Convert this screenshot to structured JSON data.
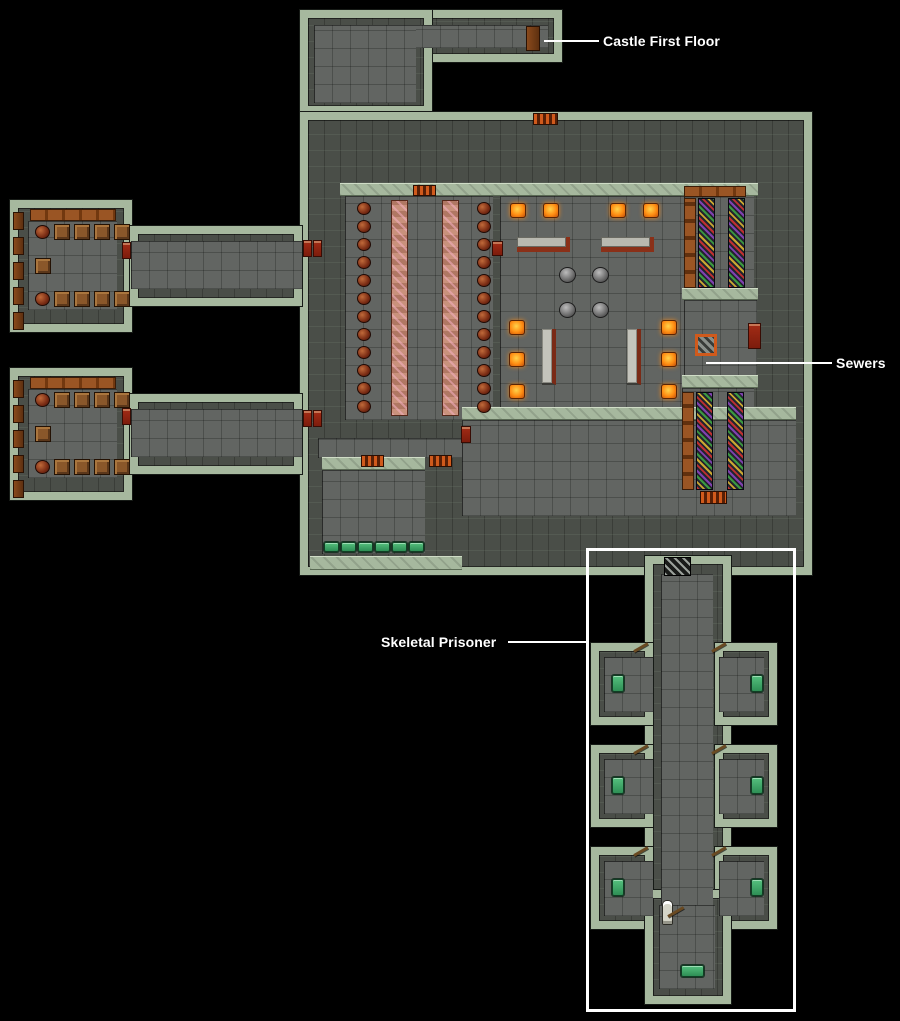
{
  "annotations": [
    {
      "id": "castle-first-floor",
      "text": "Castle First Floor"
    },
    {
      "id": "sewers",
      "text": "Sewers"
    },
    {
      "id": "skeletal-prisoner",
      "text": "Skeletal Prisoner"
    }
  ],
  "colors": {
    "background": "#000000",
    "wall_top": "#a6b89e",
    "wall_face": "#4a4e48",
    "floor": "#626562",
    "annotation": "#ffffff",
    "brazier": "#ff8c12",
    "barrel": "#7a2c14",
    "crate": "#8a572a",
    "bed_green": "#2e8f55",
    "banner_red": "#a32c16",
    "shelf_brown": "#9a5524",
    "grate_orange": "#d05a1c",
    "door_brown": "#8a4a1c"
  },
  "map": {
    "regions": [
      {
        "kind": "block",
        "name": "top-corridor",
        "x": 300,
        "y": 10,
        "w": 262,
        "h": 52
      },
      {
        "kind": "block",
        "name": "top-connector",
        "x": 300,
        "y": 10,
        "w": 132,
        "h": 104
      },
      {
        "kind": "block",
        "name": "main-dungeon",
        "x": 300,
        "y": 112,
        "w": 512,
        "h": 463
      },
      {
        "kind": "block",
        "name": "west-room-upper",
        "x": 10,
        "y": 200,
        "w": 122,
        "h": 132
      },
      {
        "kind": "block",
        "name": "west-corridor-upper",
        "x": 130,
        "y": 226,
        "w": 172,
        "h": 80
      },
      {
        "kind": "block",
        "name": "west-room-lower",
        "x": 10,
        "y": 368,
        "w": 122,
        "h": 132
      },
      {
        "kind": "block",
        "name": "west-corridor-lower",
        "x": 130,
        "y": 394,
        "w": 172,
        "h": 80
      },
      {
        "kind": "block",
        "name": "prison-corridor",
        "x": 645,
        "y": 556,
        "w": 86,
        "h": 380
      },
      {
        "kind": "block",
        "name": "prison-cell",
        "x": 591,
        "y": 643,
        "w": 62,
        "h": 82
      },
      {
        "kind": "block",
        "name": "prison-cell",
        "x": 715,
        "y": 643,
        "w": 62,
        "h": 82
      },
      {
        "kind": "block",
        "name": "prison-cell",
        "x": 591,
        "y": 745,
        "w": 62,
        "h": 82
      },
      {
        "kind": "block",
        "name": "prison-cell",
        "x": 715,
        "y": 745,
        "w": 62,
        "h": 82
      },
      {
        "kind": "block",
        "name": "prison-cell",
        "x": 591,
        "y": 847,
        "w": 62,
        "h": 82
      },
      {
        "kind": "block",
        "name": "prison-cell",
        "x": 715,
        "y": 847,
        "w": 62,
        "h": 82
      },
      {
        "kind": "block",
        "name": "prison-chamber",
        "x": 645,
        "y": 890,
        "w": 86,
        "h": 114
      },
      {
        "kind": "floor",
        "name": "top-corridor-floor",
        "x": 314,
        "y": 25,
        "w": 234,
        "h": 23
      },
      {
        "kind": "floor",
        "name": "top-connector-floor",
        "x": 314,
        "y": 25,
        "w": 102,
        "h": 78
      },
      {
        "kind": "floor",
        "name": "mess-hall",
        "x": 345,
        "y": 196,
        "w": 148,
        "h": 224
      },
      {
        "kind": "floor",
        "name": "great-hall",
        "x": 500,
        "y": 196,
        "w": 185,
        "h": 224
      },
      {
        "kind": "floor",
        "name": "armory-upper",
        "x": 684,
        "y": 190,
        "w": 70,
        "h": 98
      },
      {
        "kind": "floor",
        "name": "sewer-alcove",
        "x": 684,
        "y": 300,
        "w": 73,
        "h": 84
      },
      {
        "kind": "floor",
        "name": "armory-lower",
        "x": 682,
        "y": 388,
        "w": 72,
        "h": 112
      },
      {
        "kind": "floor",
        "name": "south-hall",
        "x": 462,
        "y": 420,
        "w": 334,
        "h": 96
      },
      {
        "kind": "floor",
        "name": "barracks",
        "x": 322,
        "y": 470,
        "w": 103,
        "h": 84
      },
      {
        "kind": "floor",
        "name": "west-connector",
        "x": 318,
        "y": 438,
        "w": 144,
        "h": 20
      },
      {
        "kind": "floor",
        "name": "west-room-upper-floor",
        "x": 28,
        "y": 221,
        "w": 89,
        "h": 89
      },
      {
        "kind": "floor",
        "name": "west-corridor-upper-floor",
        "x": 131,
        "y": 241,
        "w": 171,
        "h": 48
      },
      {
        "kind": "floor",
        "name": "west-room-lower-floor",
        "x": 28,
        "y": 389,
        "w": 89,
        "h": 89
      },
      {
        "kind": "floor",
        "name": "west-corridor-lower-floor",
        "x": 131,
        "y": 409,
        "w": 171,
        "h": 48
      },
      {
        "kind": "floor",
        "name": "prison-corridor-floor",
        "x": 661,
        "y": 574,
        "w": 52,
        "h": 350
      },
      {
        "kind": "floor",
        "name": "cell-floor",
        "x": 604,
        "y": 657,
        "w": 49,
        "h": 55
      },
      {
        "kind": "floor",
        "name": "cell-floor",
        "x": 719,
        "y": 657,
        "w": 45,
        "h": 55
      },
      {
        "kind": "floor",
        "name": "cell-floor",
        "x": 604,
        "y": 759,
        "w": 49,
        "h": 55
      },
      {
        "kind": "floor",
        "name": "cell-floor",
        "x": 719,
        "y": 759,
        "w": 45,
        "h": 55
      },
      {
        "kind": "floor",
        "name": "cell-floor",
        "x": 604,
        "y": 861,
        "w": 49,
        "h": 55
      },
      {
        "kind": "floor",
        "name": "cell-floor",
        "x": 719,
        "y": 861,
        "w": 45,
        "h": 55
      },
      {
        "kind": "floor",
        "name": "prison-chamber-floor",
        "x": 659,
        "y": 905,
        "w": 56,
        "h": 84
      },
      {
        "kind": "band",
        "name": "hall-north-wall-top",
        "x": 340,
        "y": 183,
        "w": 418,
        "h": 13
      },
      {
        "kind": "band",
        "name": "armory-upper-south-wall-top",
        "x": 682,
        "y": 288,
        "w": 76,
        "h": 12
      },
      {
        "kind": "band",
        "name": "armory-lower-north-wall-top",
        "x": 682,
        "y": 375,
        "w": 76,
        "h": 13
      },
      {
        "kind": "band",
        "name": "south-hall-north-wall-top",
        "x": 462,
        "y": 407,
        "w": 334,
        "h": 13
      },
      {
        "kind": "band",
        "name": "barracks-north-wall-top",
        "x": 322,
        "y": 457,
        "w": 103,
        "h": 13
      },
      {
        "kind": "band",
        "name": "barracks-south-wall-top",
        "x": 310,
        "y": 556,
        "w": 152,
        "h": 14
      }
    ],
    "items": [
      {
        "kind": "door",
        "name": "castle-stairs-door",
        "x": 526,
        "y": 26,
        "w": 14,
        "h": 25
      },
      {
        "kind": "table",
        "x": 391,
        "y": 200,
        "w": 17,
        "h": 216
      },
      {
        "kind": "table",
        "x": 442,
        "y": 200,
        "w": 17,
        "h": 216
      },
      {
        "kind": "barrel",
        "x": 357,
        "y": 202,
        "w": 14,
        "h": 13,
        "repeat": 12,
        "dy": 18
      },
      {
        "kind": "barrel",
        "x": 477,
        "y": 202,
        "w": 14,
        "h": 13,
        "repeat": 12,
        "dy": 18
      },
      {
        "kind": "brazier",
        "x": 510,
        "y": 203,
        "w": 16,
        "h": 15,
        "repeat": 2,
        "dx": 33
      },
      {
        "kind": "brazier",
        "x": 610,
        "y": 203,
        "w": 16,
        "h": 15,
        "repeat": 2,
        "dx": 33
      },
      {
        "kind": "brazier",
        "x": 509,
        "y": 320,
        "w": 16,
        "h": 15,
        "repeat": 3,
        "dy": 32
      },
      {
        "kind": "brazier",
        "x": 661,
        "y": 320,
        "w": 16,
        "h": 15,
        "repeat": 3,
        "dy": 32
      },
      {
        "kind": "bench",
        "x": 517,
        "y": 237,
        "w": 53,
        "h": 15
      },
      {
        "kind": "bench",
        "x": 601,
        "y": 237,
        "w": 53,
        "h": 15
      },
      {
        "kind": "cauldron",
        "x": 559,
        "y": 267,
        "w": 17,
        "h": 16,
        "repeat": 2,
        "dx": 33
      },
      {
        "kind": "cauldron",
        "x": 559,
        "y": 302,
        "w": 17,
        "h": 16,
        "repeat": 2,
        "dx": 33
      },
      {
        "kind": "altar",
        "x": 542,
        "y": 329,
        "w": 14,
        "h": 56
      },
      {
        "kind": "altar",
        "x": 627,
        "y": 329,
        "w": 14,
        "h": 56
      },
      {
        "kind": "shelf-h",
        "x": 684,
        "y": 186,
        "w": 62,
        "h": 11
      },
      {
        "kind": "shelf-v",
        "x": 684,
        "y": 198,
        "w": 12,
        "h": 90
      },
      {
        "kind": "rack",
        "x": 698,
        "y": 198,
        "w": 17,
        "h": 90
      },
      {
        "kind": "rack",
        "x": 728,
        "y": 198,
        "w": 17,
        "h": 90
      },
      {
        "kind": "shelf-v",
        "x": 682,
        "y": 392,
        "w": 12,
        "h": 98
      },
      {
        "kind": "rack",
        "x": 696,
        "y": 392,
        "w": 17,
        "h": 98
      },
      {
        "kind": "rack",
        "x": 727,
        "y": 392,
        "w": 17,
        "h": 98
      },
      {
        "kind": "grate-red",
        "x": 700,
        "y": 491,
        "w": 27,
        "h": 13
      },
      {
        "kind": "hatch",
        "name": "sewer-hatch",
        "x": 695,
        "y": 334,
        "w": 22,
        "h": 22
      },
      {
        "kind": "banner",
        "x": 303,
        "y": 240,
        "w": 9,
        "h": 17
      },
      {
        "kind": "banner",
        "x": 313,
        "y": 240,
        "w": 9,
        "h": 17
      },
      {
        "kind": "banner",
        "x": 122,
        "y": 242,
        "w": 9,
        "h": 17
      },
      {
        "kind": "banner",
        "x": 303,
        "y": 410,
        "w": 9,
        "h": 17
      },
      {
        "kind": "banner",
        "x": 313,
        "y": 410,
        "w": 9,
        "h": 17
      },
      {
        "kind": "banner",
        "x": 122,
        "y": 408,
        "w": 9,
        "h": 17
      },
      {
        "kind": "banner",
        "x": 492,
        "y": 241,
        "w": 11,
        "h": 15
      },
      {
        "kind": "banner",
        "x": 748,
        "y": 323,
        "w": 13,
        "h": 26
      },
      {
        "kind": "banner",
        "x": 461,
        "y": 426,
        "w": 10,
        "h": 17
      },
      {
        "kind": "grate-red",
        "x": 413,
        "y": 185,
        "w": 23,
        "h": 11
      },
      {
        "kind": "grate-red",
        "x": 533,
        "y": 113,
        "w": 25,
        "h": 12
      },
      {
        "kind": "grate-red",
        "x": 361,
        "y": 455,
        "w": 23,
        "h": 12
      },
      {
        "kind": "grate-red",
        "x": 429,
        "y": 455,
        "w": 23,
        "h": 12
      },
      {
        "kind": "bed-h",
        "x": 324,
        "y": 542,
        "w": 15,
        "h": 10,
        "repeat": 6,
        "dx": 17
      },
      {
        "kind": "shelf-h",
        "x": 30,
        "y": 209,
        "w": 86,
        "h": 12
      },
      {
        "kind": "crate",
        "x": 54,
        "y": 224,
        "w": 16,
        "h": 16,
        "repeat": 4,
        "dx": 20
      },
      {
        "kind": "barrel",
        "x": 35,
        "y": 225,
        "w": 15,
        "h": 14
      },
      {
        "kind": "crate",
        "x": 35,
        "y": 258,
        "w": 16,
        "h": 16
      },
      {
        "kind": "barrel",
        "x": 35,
        "y": 292,
        "w": 15,
        "h": 14
      },
      {
        "kind": "crate",
        "x": 54,
        "y": 291,
        "w": 16,
        "h": 16,
        "repeat": 4,
        "dx": 20
      },
      {
        "kind": "door",
        "x": 13,
        "y": 212,
        "w": 11,
        "h": 18,
        "repeat": 5,
        "dy": 25
      },
      {
        "kind": "shelf-h",
        "x": 30,
        "y": 377,
        "w": 86,
        "h": 12
      },
      {
        "kind": "crate",
        "x": 54,
        "y": 392,
        "w": 16,
        "h": 16,
        "repeat": 4,
        "dx": 20
      },
      {
        "kind": "barrel",
        "x": 35,
        "y": 393,
        "w": 15,
        "h": 14
      },
      {
        "kind": "crate",
        "x": 35,
        "y": 426,
        "w": 16,
        "h": 16
      },
      {
        "kind": "barrel",
        "x": 35,
        "y": 460,
        "w": 15,
        "h": 14
      },
      {
        "kind": "crate",
        "x": 54,
        "y": 459,
        "w": 16,
        "h": 16,
        "repeat": 4,
        "dx": 20
      },
      {
        "kind": "door",
        "x": 13,
        "y": 380,
        "w": 11,
        "h": 18,
        "repeat": 5,
        "dy": 25
      },
      {
        "kind": "grate-dark",
        "name": "portcullis",
        "x": 664,
        "y": 557,
        "w": 27,
        "h": 19
      },
      {
        "kind": "bed-v",
        "x": 612,
        "y": 675,
        "w": 12,
        "h": 17,
        "repeat": 3,
        "dy": 102
      },
      {
        "kind": "bed-v",
        "x": 751,
        "y": 675,
        "w": 12,
        "h": 17,
        "repeat": 3,
        "dy": 102
      },
      {
        "kind": "doorline",
        "x": 634,
        "y": 650,
        "w": 16,
        "h": 3,
        "repeat": 3,
        "dy": 102
      },
      {
        "kind": "doorline",
        "x": 712,
        "y": 650,
        "w": 16,
        "h": 3,
        "repeat": 3,
        "dy": 102
      },
      {
        "kind": "skeleton",
        "name": "skeletal-prisoner-figure",
        "x": 663,
        "y": 901,
        "w": 9,
        "h": 23
      },
      {
        "kind": "doorline",
        "x": 668,
        "y": 915,
        "w": 18,
        "h": 3
      },
      {
        "kind": "bed-h",
        "x": 681,
        "y": 965,
        "w": 23,
        "h": 12
      }
    ]
  }
}
